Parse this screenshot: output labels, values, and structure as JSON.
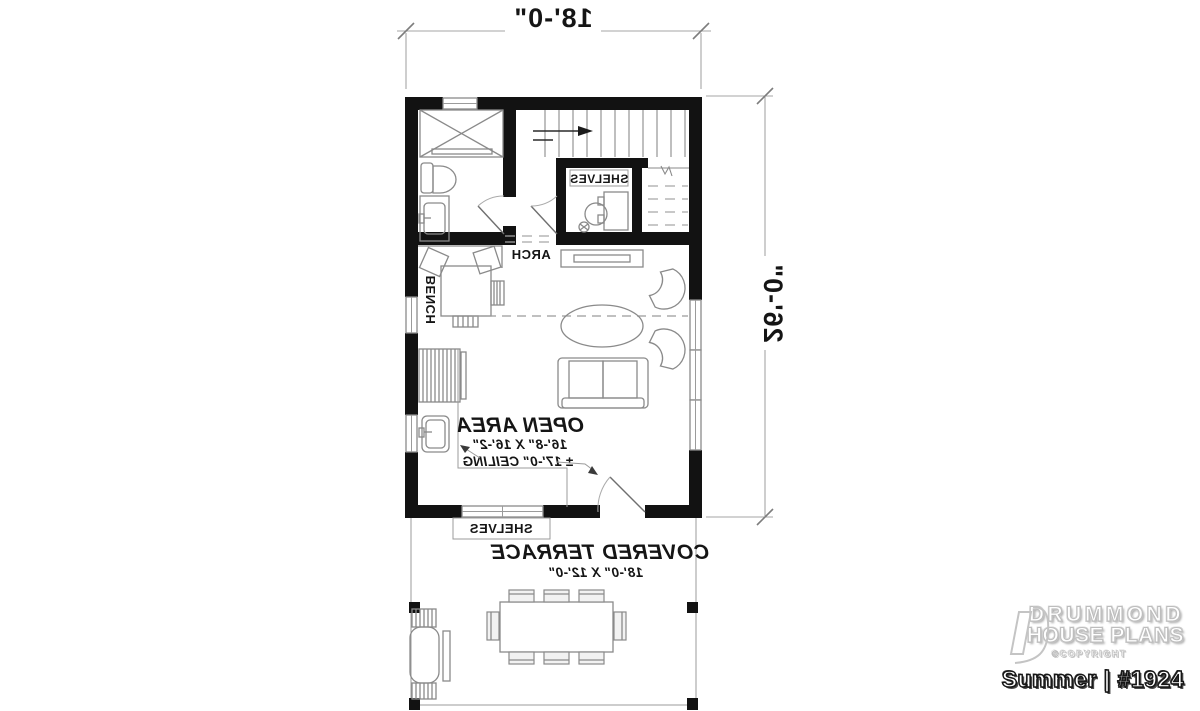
{
  "plan": {
    "dimension_top": "18'-0\"",
    "dimension_right": "26'-0\"",
    "labels": {
      "shelves_closet": "SHELVES",
      "shelves_terrace": "SHELVES",
      "arch": "ARCH",
      "bench": "BENCH"
    },
    "open_area": {
      "name": "OPEN AREA",
      "size": "16'-8\" X 16'-2\"",
      "ceiling": "± 17'-0\" CEILING"
    },
    "covered_terrace": {
      "name": "COVERED TERRACE",
      "size": "18'-0\" X 12'-0\""
    },
    "colors": {
      "wall": "#121212",
      "furniture_line": "#8a8a8a",
      "dimension_line": "#a6a6a6",
      "text": "#151515",
      "background": "#ffffff"
    }
  },
  "branding": {
    "company_line1": "DRUMMOND",
    "company_line2": "HOUSE PLANS",
    "copyright": "©COPYRIGHT",
    "plan_name": "Summer | #1924"
  }
}
